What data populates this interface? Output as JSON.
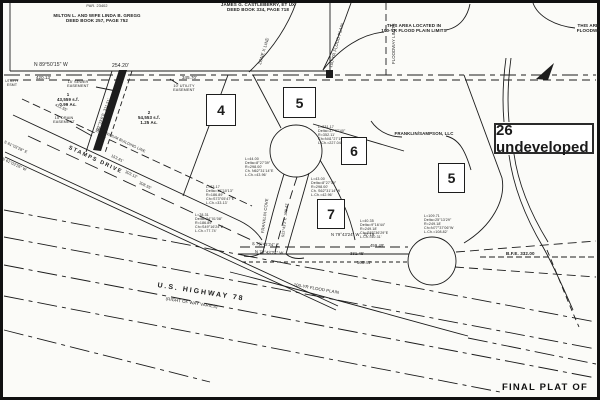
{
  "colors": {
    "ink": "#1d1d1d",
    "paper": "#fbfbf8"
  },
  "footer": {
    "text": "FINAL PLAT OF"
  },
  "annotation": {
    "name": "annotation-26-undeveloped",
    "label": "26 undeveloped",
    "x": 494,
    "y": 123,
    "w": 100,
    "h": 31
  },
  "parcel_boxes": [
    {
      "name": "parcel-box-4",
      "label": "4",
      "x": 206,
      "y": 94,
      "w": 30,
      "h": 32
    },
    {
      "name": "parcel-box-5-top",
      "label": "5",
      "x": 283,
      "y": 87,
      "w": 33,
      "h": 31
    },
    {
      "name": "parcel-box-6",
      "label": "6",
      "x": 341,
      "y": 137,
      "w": 26,
      "h": 28
    },
    {
      "name": "parcel-box-7",
      "label": "7",
      "x": 317,
      "y": 199,
      "w": 28,
      "h": 30
    },
    {
      "name": "parcel-box-5-right",
      "label": "5",
      "x": 438,
      "y": 163,
      "w": 27,
      "h": 30
    }
  ],
  "labels": [
    {
      "name": "label-parcel-number",
      "text": "PAR. 23402",
      "x": 97,
      "y": 4,
      "size": 3.8,
      "align": "c"
    },
    {
      "name": "label-owner-gregg",
      "text": "MILTON L. AND WIFE LINDA B. GREGG\nDEED BOOK 257, PAGE 752",
      "x": 97,
      "y": 13,
      "size": 4.5,
      "align": "c",
      "bold": true
    },
    {
      "name": "label-owner-castleberry",
      "text": "JAMES G. CASTLEBERRY, ET UX\nDEED BOOK 334, PAGE 718",
      "x": 258,
      "y": 2,
      "size": 4.5,
      "align": "c",
      "bold": true
    },
    {
      "name": "label-flood-area-note",
      "text": "THIS AREA LOCATED IN\n100-YR FLOOD PLAIN LIMITS",
      "x": 414,
      "y": 23,
      "size": 4.5,
      "align": "c",
      "bold": true
    },
    {
      "name": "label-floodway-note",
      "text": "THIS AREA\nFLOODWAY",
      "x": 590,
      "y": 23,
      "size": 4.5,
      "align": "c",
      "bold": true
    },
    {
      "name": "label-floodway-limits",
      "text": "FLOODWAY LIMITS",
      "x": 392,
      "y": 64,
      "rot": -90,
      "size": 4.3
    },
    {
      "name": "label-zone-x-line",
      "text": "ZONE X LINE",
      "x": 258,
      "y": 64,
      "rot": -73,
      "size": 4.3
    },
    {
      "name": "label-flood-plain-curve",
      "text": "100-YR FLOOD PLAIN",
      "x": 329,
      "y": 67,
      "rot": -75,
      "size": 4.3
    },
    {
      "name": "label-bearing-n895015",
      "text": "N 89°50'15\" W",
      "x": 34,
      "y": 63,
      "size": 5
    },
    {
      "name": "label-dist-254",
      "text": "254.20'",
      "x": 112,
      "y": 64,
      "size": 5
    },
    {
      "name": "label-dist-420",
      "text": "420.13'",
      "x": 36,
      "y": 76,
      "size": 4.4
    },
    {
      "name": "label-dist-345",
      "text": "345.70'",
      "x": 182,
      "y": 76,
      "size": 4.4
    },
    {
      "name": "label-sewer-easement",
      "text": "15' SEWER\nEASEMENT",
      "x": 78,
      "y": 80,
      "size": 3.8,
      "align": "c"
    },
    {
      "name": "label-utility-easement",
      "text": "10' UTILITY\nEASEMENT",
      "x": 184,
      "y": 84,
      "size": 3.8,
      "align": "c"
    },
    {
      "name": "label-utility-left",
      "text": "UTILITY\nESMT",
      "x": 12,
      "y": 80,
      "size": 3.5,
      "align": "c"
    },
    {
      "name": "label-lot-1-area",
      "text": "1\n43,559 s.f.\n0.99 Ac.",
      "x": 68,
      "y": 93,
      "size": 4.4,
      "align": "c",
      "bold": true
    },
    {
      "name": "label-lot-2-area",
      "text": "2\n54,553 s.f.\n1.25 Ac.",
      "x": 149,
      "y": 111,
      "size": 4.4,
      "align": "c",
      "bold": true
    },
    {
      "name": "label-drain-easement",
      "text": "15' DRAIN\nEASEMENT",
      "x": 64,
      "y": 116,
      "size": 3.8,
      "align": "c"
    },
    {
      "name": "label-sewer-bearing",
      "text": "S22°33'6\"E  311.51'",
      "x": 95,
      "y": 132,
      "rot": -70,
      "size": 3.9
    },
    {
      "name": "label-dist-413",
      "text": "413.55'",
      "x": 56,
      "y": 103,
      "rot": 25,
      "size": 3.9
    },
    {
      "name": "label-bearing-s61",
      "text": "S 61°03'28\" E",
      "x": 5,
      "y": 140,
      "rot": 25,
      "size": 3.9
    },
    {
      "name": "label-bearing-n61",
      "text": "N 61°03'26\" W",
      "x": 3,
      "y": 157,
      "rot": 25,
      "size": 3.9
    },
    {
      "name": "label-building-line",
      "text": "25' MINIMUM BUILDING LINE",
      "x": 97,
      "y": 127,
      "rot": 25,
      "size": 3.8
    },
    {
      "name": "label-stamps-drive",
      "text": "STAMPS DRIVE",
      "x": 70,
      "y": 145,
      "rot": 25,
      "size": 5.5,
      "bold": true,
      "ls": 1.5
    },
    {
      "name": "label-dist-153",
      "text": "153.81'",
      "x": 112,
      "y": 154,
      "rot": 25,
      "size": 3.9
    },
    {
      "name": "label-dist-303",
      "text": "303.12'",
      "x": 126,
      "y": 170,
      "rot": 25,
      "size": 3.9
    },
    {
      "name": "label-dist-308",
      "text": "308.55'",
      "x": 140,
      "y": 181,
      "rot": 25,
      "size": 3.9
    },
    {
      "name": "label-franklin-cove",
      "text": "FRANKLIN COVE",
      "x": 261,
      "y": 233,
      "rot": -83,
      "size": 4.2
    },
    {
      "name": "label-cove-bearing",
      "text": "S22°43'2\"E  300.47'",
      "x": 281,
      "y": 237,
      "rot": -83,
      "size": 3.7
    },
    {
      "name": "label-franklin-sampson",
      "text": "FRANKLIN/SAMPSON, LLC",
      "x": 424,
      "y": 132,
      "size": 4.4,
      "align": "c",
      "bold": true
    },
    {
      "name": "label-curve-a",
      "text": "L=44.00\nDelta=8°27'39\"\nR=298.00'\nCh. N62°31'14\"E\nL.Ch.=43.96'",
      "x": 245,
      "y": 157,
      "size": 3.6
    },
    {
      "name": "label-curve-b",
      "text": "L=231.17\nDelta=37°37'40\"\nR=352.11'\nCh=N41°27'19\"E\nL.Ch.=227.04'",
      "x": 318,
      "y": 125,
      "size": 3.6
    },
    {
      "name": "label-curve-c",
      "text": "L=33.17\nDelta=10°10'13\"\nR=186.89'\nCh=S73°05'47\"E\nL.Ch.=33.13'",
      "x": 206,
      "y": 185,
      "size": 3.6
    },
    {
      "name": "label-curve-h",
      "text": "L=78.31\nDelta=24°01'08\"\nR=186.89'\nCh=S49°16'24\"E\nL.Ch.=77.74'",
      "x": 195,
      "y": 213,
      "size": 3.6
    },
    {
      "name": "label-curve-e",
      "text": "L=43.00\nDelta=8°27'39\"\nR=298.00'\nCh. S62°31'14\"W\nL.Ch.=42.96'",
      "x": 311,
      "y": 177,
      "size": 3.6
    },
    {
      "name": "label-curve-g",
      "text": "L=40.35\nDelta=9°16'44\"\nR=249.18'\nCh=S85°36'29\"E\nL.Ch.=40.31'",
      "x": 360,
      "y": 219,
      "size": 3.6
    },
    {
      "name": "label-curve-f",
      "text": "L=109.71\nDelta=25°13'29\"\nR=249.18'\nCh=N77°37'06\"W\nL.Ch.=108.82'",
      "x": 424,
      "y": 214,
      "size": 3.6
    },
    {
      "name": "label-bearing-n7943-37",
      "text": "N 79°43'24\" W   37.19'",
      "x": 331,
      "y": 233,
      "size": 4.2
    },
    {
      "name": "label-bearing-s7943",
      "text": "S 79°43'24\" E",
      "x": 252,
      "y": 242,
      "rot": 3,
      "size": 4.2
    },
    {
      "name": "label-bearing-n7943",
      "text": "N 79°43'24\" W",
      "x": 255,
      "y": 250,
      "rot": 3,
      "size": 4.2
    },
    {
      "name": "label-dist-459",
      "text": "459.49'",
      "x": 370,
      "y": 244,
      "size": 4.2
    },
    {
      "name": "label-dist-331",
      "text": "331.45'",
      "x": 350,
      "y": 252,
      "size": 4.2
    },
    {
      "name": "label-dist-568",
      "text": "568.41'",
      "x": 357,
      "y": 261,
      "size": 4.2
    },
    {
      "name": "label-bfe",
      "text": "B.F.E. 332.00",
      "x": 506,
      "y": 251,
      "size": 4.5,
      "bold": true
    },
    {
      "name": "label-flood-plain-lower",
      "text": "100-YR FLOOD PLAIN",
      "x": 294,
      "y": 283,
      "rot": 10,
      "size": 4.3
    },
    {
      "name": "label-us-highway-78",
      "text": "U.S. HIGHWAY 78",
      "x": 158,
      "y": 282,
      "rot": 9,
      "size": 7,
      "bold": true,
      "ls": 2
    },
    {
      "name": "label-right-of-way",
      "text": "(RIGHT OF WAY VARIES)",
      "x": 166,
      "y": 297,
      "rot": 9,
      "size": 4.3
    }
  ]
}
